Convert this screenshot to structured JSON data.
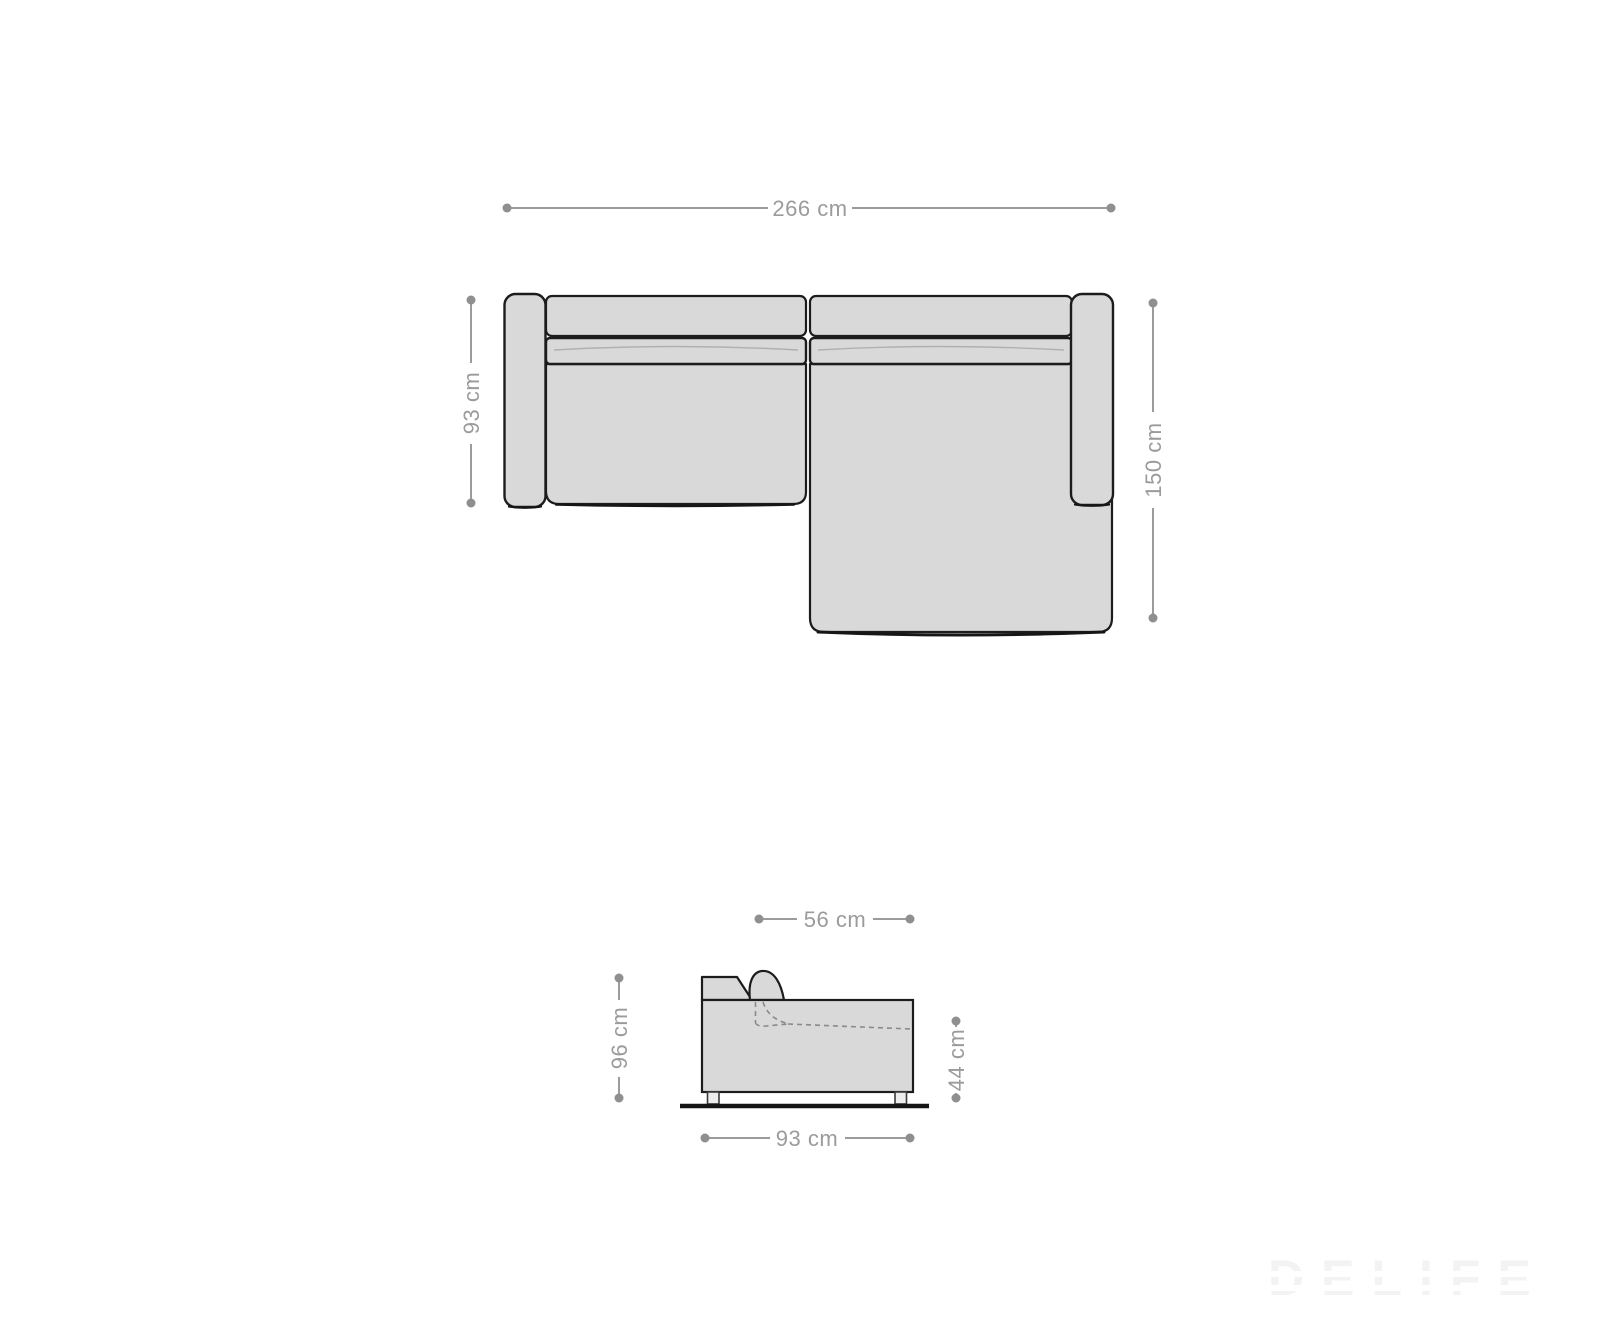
{
  "title": "Sofa dimension diagram",
  "views": {
    "top": {
      "width_label": "266 cm",
      "left_depth_label": "93 cm",
      "right_depth_label": "150 cm"
    },
    "side": {
      "seat_depth_label": "56 cm",
      "height_label": "96 cm",
      "seat_height_label": "44 cm",
      "depth_label": "93 cm"
    }
  },
  "watermark": {
    "text": "DELIFE"
  },
  "colors": {
    "background": "#ffffff",
    "sofa_fill": "#d9d9d9",
    "sofa_outline": "#1c1c1c",
    "dimension_line": "#9b9b9b",
    "dimension_dot": "#8f8f8f",
    "dashed_line": "#8a8a8a",
    "ground_line": "#151515",
    "watermark": "#f3f3f3"
  }
}
